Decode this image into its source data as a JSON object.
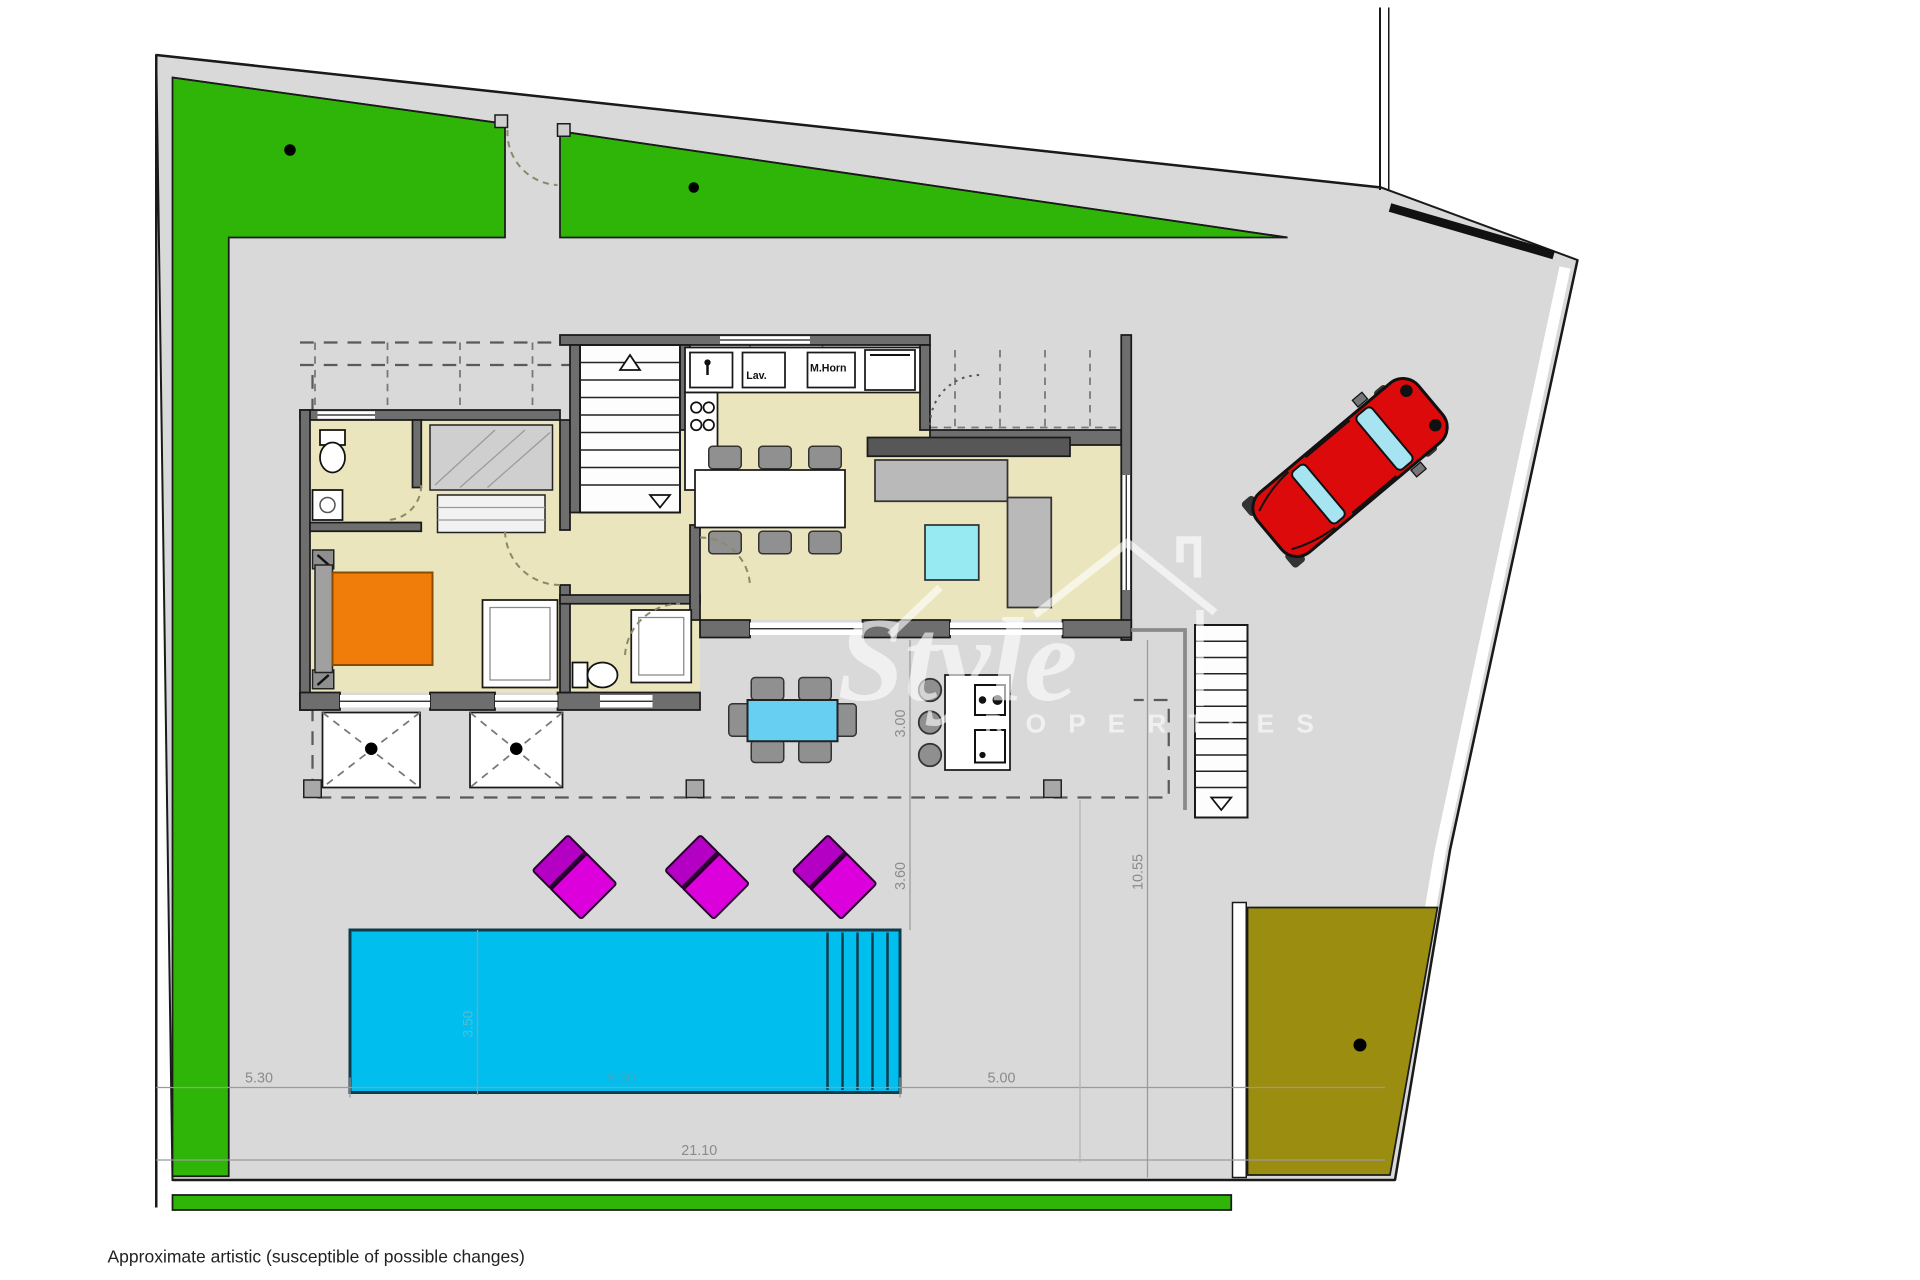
{
  "footer": {
    "note": "Approximate artistic (susceptible of possible changes)"
  },
  "watermark": {
    "brand": "Style",
    "brand_sub": "P R O P E R T I E S"
  },
  "dimensions": {
    "left_setback": "5.30",
    "pool_length": "9.30",
    "right_setback": "5.00",
    "total_width": "21.10",
    "right_depth": "10.55",
    "terrace_depth": "3.00",
    "pool_offset": "3.60",
    "pool_width": "3.50"
  },
  "kitchen": {
    "appliance_washer": "Lav.",
    "appliance_oven": "M.Horn"
  },
  "colors": {
    "grass": "#2fb408",
    "pavement": "#d9d9d9",
    "olive_garden": "#9a8d10",
    "pool_water": "#00bfef",
    "interior_floor": "#eae5bd",
    "bed_orange": "#f07d0a",
    "lounger_magenta": "#dc00dc",
    "car_red": "#dc0a0a",
    "wall_gray": "#6e6e6e"
  }
}
